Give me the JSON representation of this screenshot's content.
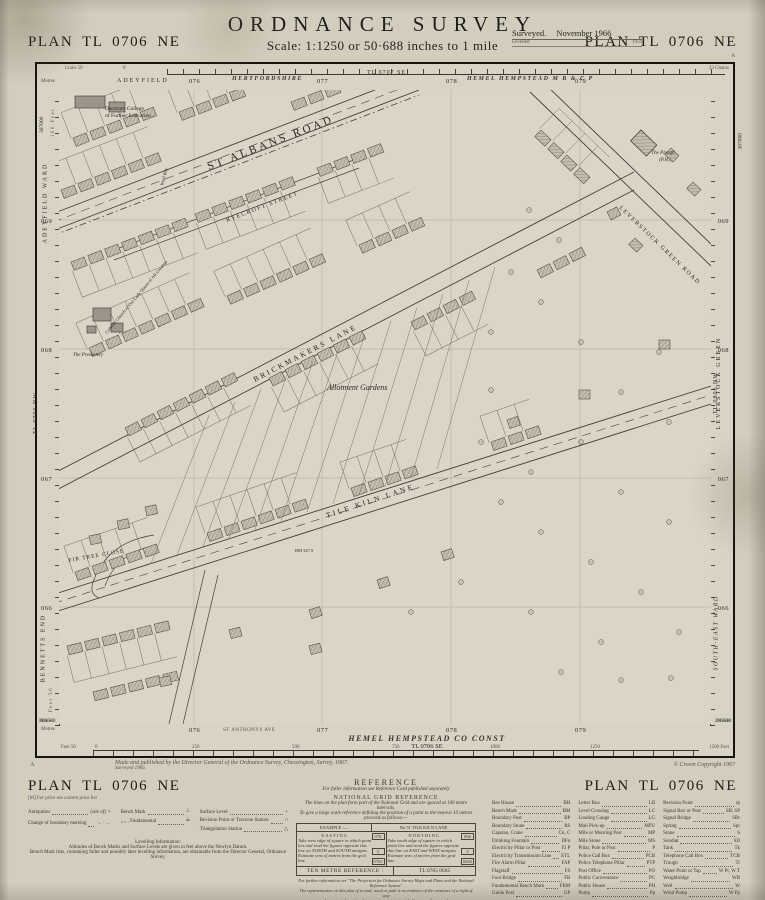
{
  "header": {
    "plan_left": "PLAN  TL 0706 NE",
    "plan_right": "PLAN  TL 0706 NE",
    "title": "ORDNANCE  SURVEY",
    "scale_line": "Scale: 1:1250 or 50·688 inches to 1 mile",
    "surveyed_label": "Surveyed.",
    "surveyed_value": "November 1966",
    "levelled_label": "Levelled",
    "levelled_value": "1956",
    "corner_mark": "A"
  },
  "map": {
    "corners": {
      "top_left": "307000",
      "top_right": "307000",
      "bottom_left": "306500",
      "bottom_right": "306500"
    },
    "top": {
      "links_label": "Links 50",
      "zero": "0",
      "metres_label": "Metres",
      "chains_label": "23 Chains",
      "ward": "ADEYFIELD",
      "county": "HERTFORDSHIRE",
      "sheet_ne": "TL 0707 SE",
      "borough": "HEMEL  HEMPSTEAD  M B  &  C P",
      "e1": "076",
      "e2": "077",
      "e3": "078",
      "e4": "079"
    },
    "left": {
      "feet_label": "100 Feet",
      "ward": "ADEYFIELD  WARD",
      "sheet": "TL 0706 NW",
      "district": "BENNETTS  END",
      "n1": "069",
      "n2": "068",
      "n3": "067",
      "n4": "066",
      "feet_bottom": "Feet 50",
      "metres_label": "Metres"
    },
    "right": {
      "green": "LEVERSTOCK  GREEN",
      "sheet": "TL 0806 NW",
      "ward": "SOUTH-EAST  WARD",
      "n1": "069",
      "n2": "068",
      "n3": "067",
      "n4": "066",
      "metres_label": "Metres"
    },
    "bottom": {
      "metres_label": "Metres",
      "e1": "076",
      "street_note": "ST ANTHONYS AVE",
      "e2": "077",
      "e3": "078",
      "e4": "079",
      "const_line1": "HEMEL  HEMPSTEAD  CO  CONST",
      "const_line2": "TL 0706 SE",
      "feet_label": "Feet 50",
      "zero": "0",
      "t250": "250",
      "t500": "500",
      "t750": "750",
      "t1000": "1000",
      "t1250": "1250",
      "feet_end": "1500 Feet"
    },
    "labels": {
      "college_1": "Dacorum College",
      "college_2": "of Further Education",
      "church": "Catholic Church of Our Lady Queen of All Creation",
      "presbytery": "The Presbytery",
      "st_albans_road": "ST  ALBANS  ROAD",
      "ward_bdy": "Ward Bdy",
      "ryecroft_street": "RYECROFT  STREET",
      "brickmakers_lane": "BRICKMAKERS  LANE",
      "allotment_gardens": "Allotment Gardens",
      "fir_tree_close": "FIR TREE CLOSE",
      "tile_kiln_lane": "TILE  KILN  LANE",
      "leverstock_green_road": "LEVERSTOCK  GREEN  ROAD",
      "plough_1": "The Plough",
      "plough_2": "(P.H.)",
      "bm_note": "BM 347.9"
    }
  },
  "imprint": {
    "corner": "A",
    "line1": "Made and published by the Director General of the Ordnance Survey, Chessington, Surrey, 1967.",
    "line2": "Surveyed 1966.",
    "copyright": "© Crown Copyright 1967"
  },
  "footer": {
    "plan_left": "PLAN  TL 0706 NE",
    "plan_right": "PLAN  TL 0706 NE",
    "price_note": "[M]   For price see current price list",
    "legend": {
      "antiquities_label": "Antiquities",
      "antiquities_suffix": "(site of)",
      "antiquities_sym": "×",
      "boundary_label": "Change of boundary mereing",
      "boundary_sym": "→ · ←",
      "bench_label": "Bench Mark",
      "bench_sym": "┴",
      "bench2_label": "„   „  , Fundamental",
      "bench2_sym": "╧",
      "surface_label": "Surface Level",
      "surface_sym": "+",
      "revision_label": "Revision Point or Traverse Station",
      "revision_sym": "○",
      "triangulation_label": "Triangulation Station",
      "triangulation_sym": "△"
    },
    "levelling": {
      "title": "Levelling Information:",
      "line1": "Altitudes of Bench Marks and Surface Levels are given in feet above the Newlyn Datum.",
      "line2": "Bench Mark lists, containing fuller and possibly later levelling information, are obtainable from the Director General, Ordnance Survey."
    },
    "reference": {
      "title": "REFERENCE",
      "subtitle": "For fuller information see Reference Card published separately",
      "grid_title": "NATIONAL  GRID  REFERENCE",
      "line1": "The lines on the plan form part of the National Grid and are spaced at 100 metre intervals.",
      "line2": "To give a large scale reference defining the position of a point to the nearest 10 metres proceed as follows:—",
      "example_label": "EXAMPLE :—",
      "example_value": "No 51  TILE  KILN  LANE",
      "easting_title": "EASTING",
      "easting_text": "Take west edge of square in which point lies and read the figures opposite this line on NORTH and SOUTH margins",
      "easting_est": "Estimate tens of metres from the grid line",
      "easting_val1": "076",
      "easting_val2": "5",
      "easting_total": "0765",
      "northing_title": "NORTHING",
      "northing_text": "Take south edge of square in which point lies and read the figures opposite this line on EAST and WEST margins",
      "northing_est": "Estimate tens of metres from the grid line",
      "northing_val1": "066",
      "northing_val2": "5",
      "northing_total": "0665",
      "ten_metre_label": "TEN  METRE  REFERENCE :",
      "ten_metre_value": "TL 0765 0665",
      "foot1": "For further information see \"The Projection for Ordnance Survey Maps and Plans and the National Reference System\"",
      "foot2": "The representation on this plan of a road, track or path is no evidence of the existence of a right of way",
      "foot3": "1 square inch on this plan represents approximately ¼ acre on the ground",
      "foot4": "The alinement of symbols where shown is approximate"
    },
    "abbreviations": {
      "col1": [
        {
          "t": "Bee House",
          "a": "BH"
        },
        {
          "t": "Bench Mark",
          "a": "BM"
        },
        {
          "t": "Boundary Post",
          "a": "BP"
        },
        {
          "t": "Boundary Stone",
          "a": "BS"
        },
        {
          "t": "Capstan, Crane",
          "a": "Cn, C"
        },
        {
          "t": "Drinking Fountain",
          "a": "DFn"
        },
        {
          "t": "Electricity Pillar or Post",
          "a": "El P"
        },
        {
          "t": "Electricity Transmission Line",
          "a": "ETL"
        },
        {
          "t": "Fire Alarm Pillar",
          "a": "FAP"
        },
        {
          "t": "Flagstaff",
          "a": "FS"
        },
        {
          "t": "Foot Bridge",
          "a": "FB"
        },
        {
          "t": "Fundamental Bench Mark",
          "a": "FBM"
        },
        {
          "t": "Guide Post",
          "a": "GP"
        }
      ],
      "col2": [
        {
          "t": "Letter Box",
          "a": "LB"
        },
        {
          "t": "Level Crossing",
          "a": "LC"
        },
        {
          "t": "Loading Gauge",
          "a": "LG"
        },
        {
          "t": "Mail Pick-up",
          "a": "MPU"
        },
        {
          "t": "Mile or Mooring Post",
          "a": "MP"
        },
        {
          "t": "Mile Stone",
          "a": "MS"
        },
        {
          "t": "Pillar, Pole or Post",
          "a": "P"
        },
        {
          "t": "Police Call Box",
          "a": "PCB"
        },
        {
          "t": "Police Telephone Pillar",
          "a": "PTP"
        },
        {
          "t": "Post Office",
          "a": "PO"
        },
        {
          "t": "Public Convenience",
          "a": "PC"
        },
        {
          "t": "Public House",
          "a": "PH"
        },
        {
          "t": "Pump",
          "a": "Pp"
        }
      ],
      "col3": [
        {
          "t": "Revision Point",
          "a": "rp"
        },
        {
          "t": "Signal Box or Post",
          "a": "SB, SP"
        },
        {
          "t": "Signal Bridge",
          "a": "SBr"
        },
        {
          "t": "Spring",
          "a": "Spr"
        },
        {
          "t": "Stone",
          "a": "S"
        },
        {
          "t": "Sundial",
          "a": "SD"
        },
        {
          "t": "Tank",
          "a": "Tk"
        },
        {
          "t": "Telephone Call Box",
          "a": "TCB"
        },
        {
          "t": "Trough",
          "a": "Tr"
        },
        {
          "t": "Water Point or Tap",
          "a": "W Pt, W T"
        },
        {
          "t": "Weighbridge",
          "a": "WB"
        },
        {
          "t": "Well",
          "a": "W"
        },
        {
          "t": "Wind Pump",
          "a": "W Pp"
        }
      ],
      "bottom_left_t": "Mean High or Low Water",
      "bottom_left_a": "MHW or MLW",
      "bottom_right_t": "Mean High or Low Water Springs",
      "bottom_right_a": "MHWS or MLWS"
    }
  }
}
